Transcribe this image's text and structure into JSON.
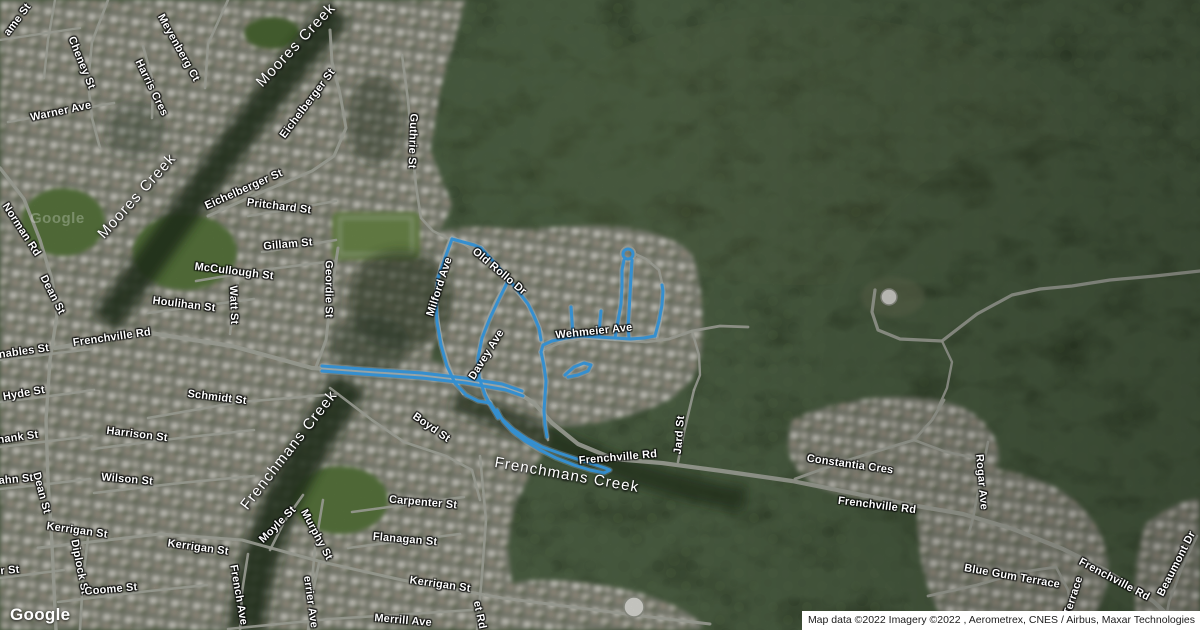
{
  "map": {
    "theme": {
      "route_color": "#3fa9f5",
      "route_halo": "#bfe3ff",
      "road_color": "#aeb1a7",
      "forest_color": "#2f3d26",
      "suburb_color": "#878b7c",
      "park_color": "#5c7a40",
      "creek_color": "#22301c",
      "label_color": "#ffffff"
    },
    "street_labels": [
      {
        "text": "ame St",
        "x": 18,
        "y": 20,
        "rot": -53
      },
      {
        "text": "Cheney St",
        "x": 81,
        "y": 63,
        "rot": 68
      },
      {
        "text": "Meyenberg Ct",
        "x": 178,
        "y": 48,
        "rot": 61
      },
      {
        "text": "Harris Cres",
        "x": 151,
        "y": 88,
        "rot": 64
      },
      {
        "text": "Warner Ave",
        "x": 61,
        "y": 112,
        "rot": -12
      },
      {
        "text": "Eichelberger St",
        "x": 308,
        "y": 104,
        "rot": -53
      },
      {
        "text": "Guthrie St",
        "x": 412,
        "y": 141,
        "rot": 92
      },
      {
        "text": "Eichelberger St",
        "x": 244,
        "y": 190,
        "rot": -24
      },
      {
        "text": "Pritchard St",
        "x": 279,
        "y": 207,
        "rot": 7
      },
      {
        "text": "Norman Rd",
        "x": 21,
        "y": 230,
        "rot": 57
      },
      {
        "text": "Gillam St",
        "x": 288,
        "y": 245,
        "rot": -5
      },
      {
        "text": "McCullough St",
        "x": 234,
        "y": 272,
        "rot": 7
      },
      {
        "text": "Geordie St",
        "x": 328,
        "y": 289,
        "rot": 90
      },
      {
        "text": "Dean St",
        "x": 52,
        "y": 295,
        "rot": 63
      },
      {
        "text": "Houlihan St",
        "x": 184,
        "y": 305,
        "rot": 7
      },
      {
        "text": "Watt St",
        "x": 233,
        "y": 305,
        "rot": 88
      },
      {
        "text": "Frenchville Rd",
        "x": 112,
        "y": 338,
        "rot": -8
      },
      {
        "text": "nables St",
        "x": 24,
        "y": 352,
        "rot": -8
      },
      {
        "text": "Milford Ave",
        "x": 440,
        "y": 287,
        "rot": -72
      },
      {
        "text": "Old Rollo Dr",
        "x": 499,
        "y": 272,
        "rot": 40
      },
      {
        "text": "Davey Ave",
        "x": 487,
        "y": 355,
        "rot": -58
      },
      {
        "text": "Wehmeier Ave",
        "x": 594,
        "y": 332,
        "rot": -6
      },
      {
        "text": "Hyde St",
        "x": 24,
        "y": 394,
        "rot": -10
      },
      {
        "text": "Schmidt St",
        "x": 217,
        "y": 398,
        "rot": 7
      },
      {
        "text": "Boyd St",
        "x": 431,
        "y": 428,
        "rot": 35
      },
      {
        "text": "hank St",
        "x": 18,
        "y": 438,
        "rot": -8
      },
      {
        "text": "Harrison St",
        "x": 137,
        "y": 435,
        "rot": 7
      },
      {
        "text": "Wilson St",
        "x": 127,
        "y": 480,
        "rot": 5
      },
      {
        "text": "ahn St",
        "x": 16,
        "y": 480,
        "rot": -5
      },
      {
        "text": "Dean St",
        "x": 41,
        "y": 493,
        "rot": 75
      },
      {
        "text": "Frenchville Rd",
        "x": 618,
        "y": 458,
        "rot": -5
      },
      {
        "text": "Jard St",
        "x": 680,
        "y": 435,
        "rot": -85
      },
      {
        "text": "Constantia Cres",
        "x": 850,
        "y": 465,
        "rot": 8
      },
      {
        "text": "Rogar Ave",
        "x": 981,
        "y": 482,
        "rot": 85
      },
      {
        "text": "Frenchville Rd",
        "x": 877,
        "y": 506,
        "rot": 7
      },
      {
        "text": "Kerrigan St",
        "x": 77,
        "y": 531,
        "rot": 8
      },
      {
        "text": "Kerrigan St",
        "x": 198,
        "y": 548,
        "rot": 8
      },
      {
        "text": "Moyle St",
        "x": 278,
        "y": 525,
        "rot": -45
      },
      {
        "text": "Murphy St",
        "x": 316,
        "y": 535,
        "rot": 62
      },
      {
        "text": "Diplock St",
        "x": 79,
        "y": 567,
        "rot": 79
      },
      {
        "text": "Coome St",
        "x": 111,
        "y": 590,
        "rot": -5
      },
      {
        "text": "r St",
        "x": 10,
        "y": 571,
        "rot": -5
      },
      {
        "text": "Carpenter St",
        "x": 423,
        "y": 503,
        "rot": 5
      },
      {
        "text": "Flanagan St",
        "x": 405,
        "y": 540,
        "rot": 5
      },
      {
        "text": "Kerrigan St",
        "x": 440,
        "y": 585,
        "rot": 8
      },
      {
        "text": "French Ave",
        "x": 238,
        "y": 595,
        "rot": 80
      },
      {
        "text": "errier Ave",
        "x": 310,
        "y": 602,
        "rot": 82
      },
      {
        "text": "Merrill Ave",
        "x": 403,
        "y": 621,
        "rot": 5
      },
      {
        "text": "et Rd",
        "x": 479,
        "y": 615,
        "rot": 78
      },
      {
        "text": "Blue Gum Terrace",
        "x": 1012,
        "y": 577,
        "rot": 10
      },
      {
        "text": "Terrace",
        "x": 1074,
        "y": 596,
        "rot": -72
      },
      {
        "text": "Frenchville Rd",
        "x": 1114,
        "y": 580,
        "rot": 28
      },
      {
        "text": "Beaumont Dr",
        "x": 1177,
        "y": 564,
        "rot": -63
      }
    ],
    "creek_labels": [
      {
        "text": "Moores Creek",
        "x": 296,
        "y": 45,
        "rot": -47
      },
      {
        "text": "Moores Creek",
        "x": 137,
        "y": 196,
        "rot": -48
      },
      {
        "text": "Frenchmans Creek",
        "x": 289,
        "y": 450,
        "rot": -52
      },
      {
        "text": "Frenchmans Creek",
        "x": 567,
        "y": 475,
        "rot": 10
      }
    ],
    "roads": [
      {
        "p": "55,348 150,333 232,346 312,368 402,374 468,381 512,389 534,403 552,423 578,444 614,459 662,463 722,471 792,481 852,493 917,506 963,514 1013,529 1063,549 1107,571 1153,601 1184,630",
        "w": 4.2
      },
      {
        "p": "0,168 24,199 40,240 52,280 57,315 50,360 46,420 48,480 52,545 56,630",
        "w": 3.4
      },
      {
        "p": "38,548 160,534 242,540 322,562 402,580 502,598 642,616 710,624",
        "w": 3
      },
      {
        "p": "148,418 240,402 338,394",
        "w": 2.6
      },
      {
        "p": "92,449 180,438 254,430",
        "w": 2.6
      },
      {
        "p": "94,493 180,483 254,476",
        "w": 2.6
      },
      {
        "p": "58,602 140,592 207,585",
        "w": 2.6
      },
      {
        "p": "0,402 50,396 94,390",
        "w": 2.6
      },
      {
        "p": "0,447 50,441 92,436",
        "w": 2.6
      },
      {
        "p": "0,489 48,484 90,479",
        "w": 2.6
      },
      {
        "p": "0,360 50,354 92,349",
        "w": 2.6
      },
      {
        "p": "0,578 40,573 64,570",
        "w": 2.6
      },
      {
        "p": "228,629 330,619 472,610",
        "w": 2.6
      },
      {
        "p": "108,0 92,42 88,82 92,118 100,148",
        "w": 2.6
      },
      {
        "p": "228,0 208,44 205,88",
        "w": 2.6
      },
      {
        "p": "8,122 62,112 114,103",
        "w": 2.6
      },
      {
        "p": "143,46 153,82 152,118",
        "w": 2.6
      },
      {
        "p": "55,0 48,40 44,78",
        "w": 2.4
      },
      {
        "p": "0,40 40,34 80,28",
        "w": 2.4
      },
      {
        "p": "196,281 262,270 334,261",
        "w": 2.6
      },
      {
        "p": "148,313 200,306 254,299",
        "w": 2.6
      },
      {
        "p": "262,252 300,246 336,240",
        "w": 2.6
      },
      {
        "p": "248,216 292,209 336,201",
        "w": 2.6
      },
      {
        "p": "238,282 233,310 230,334",
        "w": 2.6
      },
      {
        "p": "338,248 331,295 326,340 316,367",
        "w": 3
      },
      {
        "p": "208,216 262,192 312,171 334,156 346,128 340,94 332,62 330,30",
        "w": 3
      },
      {
        "p": "402,55 408,100 412,145 416,186 421,218 433,231 449,239",
        "w": 2.6
      },
      {
        "p": "330,388 372,420 404,442 446,456 472,470 480,500",
        "w": 2.6
      },
      {
        "p": "480,456 486,520 482,575 477,630",
        "w": 2.6
      },
      {
        "p": "352,512 404,505 464,497",
        "w": 2.6
      },
      {
        "p": "348,548 402,541 460,534",
        "w": 2.6
      },
      {
        "p": "248,554 242,592 240,630",
        "w": 2.6
      },
      {
        "p": "303,495 284,522 270,550",
        "w": 2.6
      },
      {
        "p": "323,500 315,548 311,592 309,630",
        "w": 2.6
      },
      {
        "p": "319,563 312,596 308,630",
        "w": 2.6
      },
      {
        "p": "88,538 83,578 80,630",
        "w": 2.6
      },
      {
        "p": "694,390 684,432 678,462",
        "w": 2.6
      },
      {
        "p": "795,479 842,462 884,449 914,440 932,420 944,400",
        "w": 2.8
      },
      {
        "p": "914,440 946,452 976,458",
        "w": 2.6
      },
      {
        "p": "988,442 980,482 973,518 969,533",
        "w": 2.6
      },
      {
        "p": "928,596 977,585 1022,572 1056,567",
        "w": 2.8
      },
      {
        "p": "1056,567 1068,590 1072,614 1070,630",
        "w": 2.6
      },
      {
        "p": "1197,536 1181,570 1169,602 1164,630",
        "w": 2.6
      },
      {
        "p": "875,290 872,312 878,330 900,339 942,341 977,314 1012,295 1040,289 1072,286 1110,280 1155,276 1200,271",
        "w": 3.2
      },
      {
        "p": "942,341 952,362 947,388 938,408",
        "w": 2.4
      },
      {
        "p": "452,236 470,248 490,266 510,285 524,300 535,316 542,333 543,350",
        "w": 2.8
      },
      {
        "p": "506,282 495,302 486,322 480,345 479,368 485,392 493,409",
        "w": 2.8
      },
      {
        "p": "543,350 562,342 587,338 616,340 646,342 669,339 692,331 720,326 748,327",
        "w": 2.8
      },
      {
        "p": "657,340 662,315 664,292 659,270 646,259 633,253",
        "w": 2.6
      },
      {
        "p": "450,238 441,262 436,288 437,312 441,338 448,362 455,380 463,394",
        "w": 2.6
      },
      {
        "p": "543,350 545,368 545,390 544,410 546,428 548,440",
        "w": 2.6
      },
      {
        "p": "692,331 699,355 700,375 694,390",
        "w": 2.4
      }
    ],
    "route": {
      "paths": [
        "322,366 362,369 422,373 464,378 502,384 522,391",
        "322,371 362,374 422,378 466,383 506,390 523,396",
        "452,239 445,258 438,278 436,300 437,322 441,345 447,366 455,383 466,395 478,401 490,403",
        "452,239 463,242 474,245 481,248",
        "481,248 493,261 506,276 518,291 528,304 534,316 539,328 541,340",
        "508,281 499,299 490,318 482,338 478,358 479,377 485,395 492,408 498,418",
        "541,352 543,345 552,341 566,338 581,336 598,337 615,338 630,339 644,338 655,336",
        "655,336 659,321 662,305 663,291 662,285",
        "615,338 618,321 621,304 622,287 622,270 624,260",
        "632,260 631,277 630,294 629,312 628,327 629,338",
        "573,337 572,321 571,307",
        "599,337 600,321 601,311",
        "541,352 544,366 546,381 545,396 544,411 545,425 547,437",
        "490,403 496,412 504,421 514,430 527,439 542,447 559,453 577,459 593,464 605,468 610,470 604,473 590,470 574,465 556,458 540,450 525,441 512,431 503,421 497,410",
        "565,375 574,367 584,363 591,365 588,371 578,375 568,377"
      ],
      "cul_de_sac": {
        "cx": 628,
        "cy": 254,
        "r": 5
      }
    },
    "landmarks": {
      "tanks": [
        {
          "cx": 889,
          "cy": 297,
          "r": 8
        },
        {
          "cx": 634,
          "cy": 607,
          "r": 10
        }
      ]
    }
  },
  "branding": {
    "logo_text": "Google",
    "watermark_text": "Google"
  },
  "attribution": {
    "text": "Map data ©2022 Imagery ©2022 , Aerometrex, CNES / Airbus, Maxar Technologies"
  }
}
